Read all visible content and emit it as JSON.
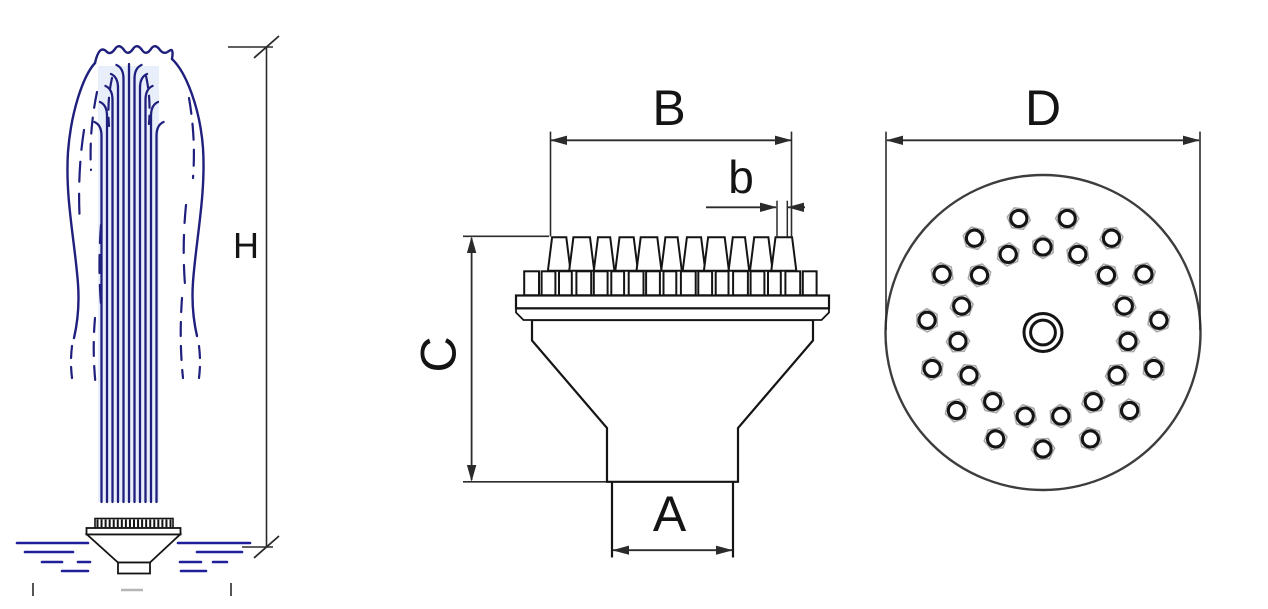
{
  "drawing": {
    "title": "fountain nozzle technical drawing",
    "colors": {
      "spray_blue": "#1f1f7d",
      "water_blue": "#1f1f99",
      "line_black": "#141414",
      "dim_gray": "#2b2b2b",
      "nut_gray": "#a9a9a9",
      "circle_gray": "#3d3d3d",
      "column_tint": "#e9eefb",
      "faint_gray": "#b5b5b5"
    },
    "views": {
      "fountain_profile": {
        "description": "side profile of fountain spray column over nozzle",
        "height_dim_label": "H",
        "jet_count": 11,
        "nozzle_dot_count": 19
      },
      "nozzle_side_view": {
        "description": "front elevation of cluster nozzle",
        "top_width_dim_label": "B",
        "single_tip_width_dim_label": "b",
        "height_dim_label": "C",
        "inlet_width_dim_label": "A",
        "tip_count": 11,
        "nut_count": 17
      },
      "nozzle_plan_view": {
        "description": "top plan of nozzle plate",
        "diameter_dim_label": "D",
        "outer_ring_nozzle_count": 15,
        "inner_ring_nozzle_count": 15,
        "total_nozzle_count": 30,
        "center_hole": true
      }
    }
  }
}
